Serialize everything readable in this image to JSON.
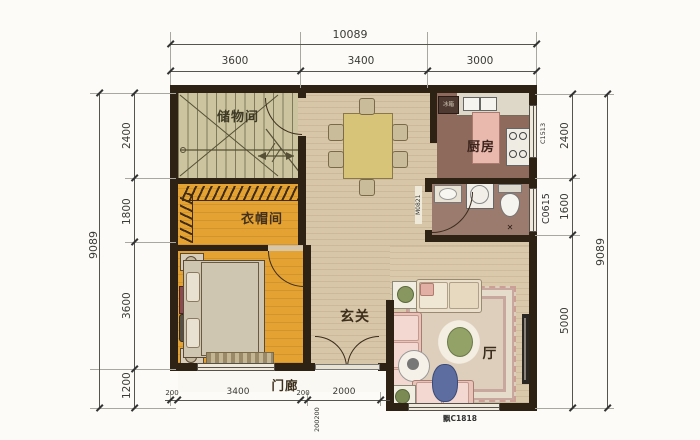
{
  "dims": {
    "top": {
      "total": "10089",
      "segments": [
        "3600",
        "3400",
        "3000"
      ]
    },
    "left": {
      "total": "9089",
      "segments": [
        "2400",
        "1800",
        "3600",
        "1200"
      ]
    },
    "right": {
      "total": "9089",
      "segments": [
        "2400",
        "1600",
        "5000"
      ]
    },
    "bottom": {
      "segments": [
        "200",
        "3400",
        "200",
        "2000"
      ],
      "stacked": "200200"
    }
  },
  "rooms": {
    "storage": "储物间",
    "kitchen": "厨房",
    "cloakroom": "衣帽间",
    "entry": "玄关",
    "porch": "门廊",
    "living": "厅"
  },
  "appliances": {
    "fridge": "冰箱"
  },
  "codes": {
    "kitchen_window": "C1513",
    "bath_window": "C0615",
    "bath_door": "M0821",
    "bay_window": "飘C1818"
  },
  "colors": {
    "wall": "#2e2214",
    "wood_floor": "#d8c6a8",
    "kitchen_floor": "#8e6a5c",
    "bath_floor": "#9b7b6e",
    "bedroom_floor": "#e4a233",
    "stairs_floor": "#cbc49e",
    "rug": "#decfbc",
    "sofa": "#e9c2b8",
    "dining_table": "#d8c478"
  }
}
